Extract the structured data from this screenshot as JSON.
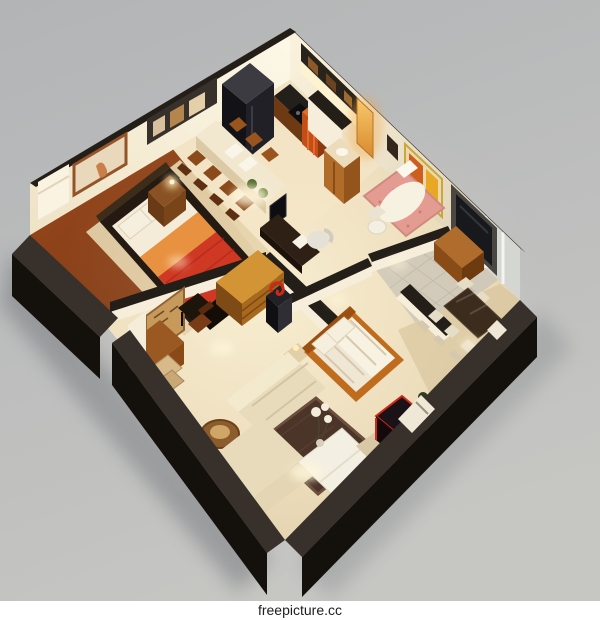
{
  "image": {
    "watermark": "freepicture.cc",
    "subject": "3d-isometric-apartment-floor-plan-render"
  },
  "colors": {
    "bg_top": "#b4b6b8",
    "bg_bottom": "#c4c4c2",
    "shadow": "#72757a",
    "wall_cap": "#241e18",
    "wall_face": "#f6eedb",
    "wall_cut_top": "#38302a",
    "wall_cut_side": "#14100b",
    "floor_main": "#ecdcba",
    "floor_bedroom": "#8e4318",
    "floor_dining": "#d9c7a0",
    "floor_tile": "#cdc5b7",
    "rug_living": "#4b3428",
    "rug_bedroom": "#e2cfa8",
    "bed_red": "#cf3822",
    "bed_orange": "#e89140",
    "pillow": "#f6efdd",
    "sofa": "#e8dbbb",
    "wood": "#a8642a",
    "wood_dark": "#7a4014",
    "appliance": "#17171b",
    "tub_pink": "#e49b92",
    "mirror_glow": "#f0a440",
    "tv_panel": "#4a4642",
    "screen": "#17191d",
    "accent_red": "#d02818",
    "glow": "#fff6da",
    "watermark_bg": "#ffffff",
    "watermark_text": "#1d1d1d"
  },
  "scene": {
    "rooms": [
      "master bedroom",
      "kitchen with island dining",
      "bathroom",
      "tiled hallway",
      "study",
      "second bedroom",
      "dining area",
      "living room"
    ]
  }
}
